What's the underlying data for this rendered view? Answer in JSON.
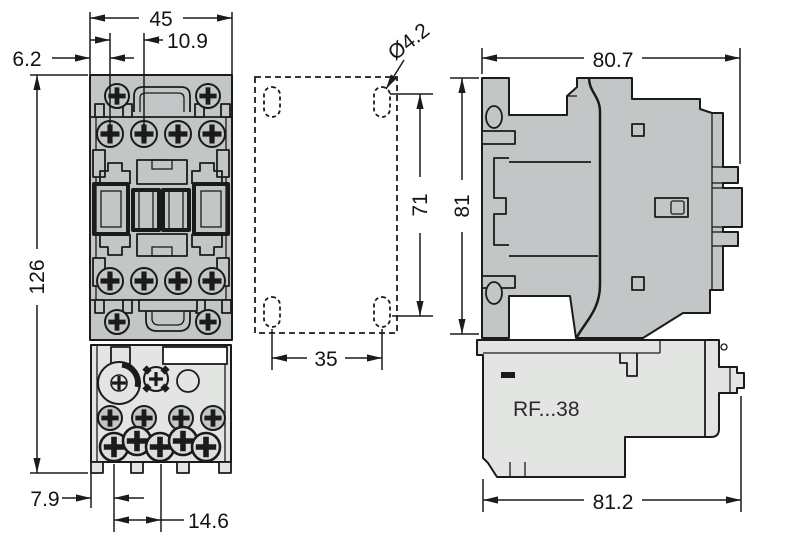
{
  "colors": {
    "line": "#1b1b1b",
    "contactor_body": "#c3c6c6",
    "relay_body": "#e3e5e3",
    "background": "#ffffff"
  },
  "front_view": {
    "overall_width": "45",
    "mount_hole_pitch": "10.9",
    "edge_to_hole": "6.2",
    "overall_height": "126",
    "base_edge_offset": "7.9",
    "terminal_pitch": "14.6"
  },
  "drilling_plan": {
    "hole_diameter": "Ø4.2",
    "vertical_pitch": "71",
    "horizontal_pitch": "35"
  },
  "side_view": {
    "depth_top": "80.7",
    "height": "81",
    "depth_bottom": "81.2",
    "relay_model": "RF...38"
  }
}
